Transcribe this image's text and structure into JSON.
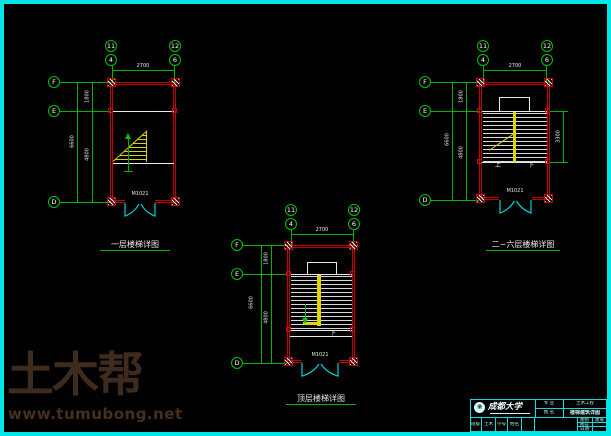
{
  "colors": {
    "background": "#000000",
    "border_cyan": "#00e6e6",
    "grid_green": "#00b400",
    "wall_red": "#c60000",
    "stair_yellow": "#dfd700",
    "annotation_white": "#e9e9e9",
    "titleblock_cyan": "#17d8d8",
    "watermark_brown": "#3d2b1d"
  },
  "drawings": [
    {
      "name": "first-floor",
      "caption": "一层楼梯详图",
      "grid": {
        "col_upper": [
          "11",
          "12"
        ],
        "col_lower": [
          "4",
          "6"
        ],
        "rows": [
          "F",
          "E",
          "D"
        ]
      },
      "door_label": "M1021",
      "dims": {
        "width": "2700",
        "upper": "1800",
        "lower": "4800",
        "total": "6600"
      }
    },
    {
      "name": "floors-2-to-6",
      "caption": "二~六层楼梯详图",
      "grid": {
        "col_upper": [
          "11",
          "12"
        ],
        "col_lower": [
          "4",
          "6"
        ],
        "rows": [
          "F",
          "E",
          "D"
        ]
      },
      "door_label": "M1021",
      "up_label": "上",
      "down_label": "下",
      "dims": {
        "width": "2700",
        "upper": "1800",
        "lower": "4800",
        "total": "6600",
        "flight": "3300"
      }
    },
    {
      "name": "top-floor",
      "caption": "顶层楼梯详图",
      "grid": {
        "col_upper": [
          "11",
          "12"
        ],
        "col_lower": [
          "4",
          "6"
        ],
        "rows": [
          "F",
          "E",
          "D"
        ]
      },
      "door_label": "M1021",
      "down_label": "下",
      "dims": {
        "width": "2700",
        "upper": "1800",
        "lower": "4800",
        "total": "6600"
      }
    }
  ],
  "title_block": {
    "logo_glyph": "❀",
    "university": "成都大学",
    "fields": [
      {
        "label": "专 业",
        "value": "土木工程"
      },
      {
        "label": "图 名",
        "value": "楼梯建筑详图"
      }
    ],
    "bottom_cells": [
      "班级",
      "土木",
      "学号",
      "姓名"
    ],
    "corner_fields": [
      {
        "label": "图别",
        "value": "建施"
      },
      {
        "label": "图号",
        "value": ""
      },
      {
        "label": "日期",
        "value": ""
      }
    ]
  },
  "watermark": {
    "brand": "土木帮",
    "site": "www.tumubong.net"
  }
}
